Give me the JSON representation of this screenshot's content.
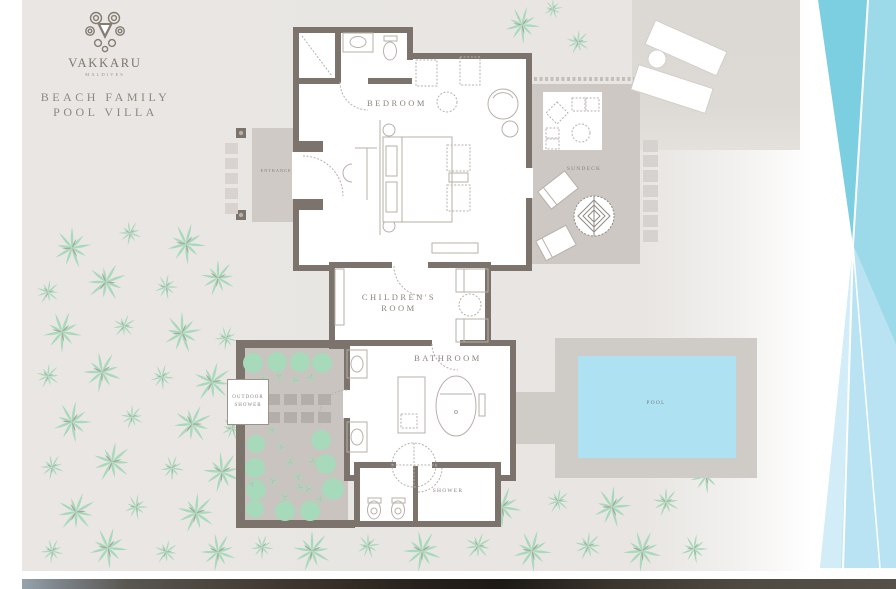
{
  "brand": {
    "name": "VAKKARU",
    "location": "MALDIVES"
  },
  "title": {
    "line1": "BEACH FAMILY",
    "line2": "POOL VILLA"
  },
  "labels": {
    "bedroom": "BEDROOM",
    "childrens_line1": "CHILDREN'S",
    "childrens_line2": "ROOM",
    "bathroom": "BATHROOM",
    "entrance": "ENTRANCE",
    "sundeck": "SUNDECK",
    "outdoor_line1": "OUTDOOR",
    "outdoor_line2": "SHOWER",
    "shower": "SHOWER",
    "pool": "POOL"
  },
  "colors": {
    "background": "#e9e6e3",
    "wall": "#7b736c",
    "room_fill": "#ffffff",
    "deck": "#cfcac5",
    "palm_green": "#a7d9bb",
    "pool_water": "#aee1f2",
    "wave_dark": "#7ccfe1",
    "wave_mid": "#9cdaea",
    "wave_light": "#b9e3f3",
    "wave_pale": "#d3edf8",
    "label_text": "#8a837b"
  },
  "decor": {
    "palms": [
      [
        72,
        248,
        1,
        0
      ],
      [
        130,
        233,
        0.6,
        30
      ],
      [
        186,
        244,
        1,
        15
      ],
      [
        48,
        292,
        0.62,
        50
      ],
      [
        106,
        282,
        1,
        70
      ],
      [
        166,
        287,
        0.62,
        10
      ],
      [
        218,
        278,
        0.9,
        40
      ],
      [
        62,
        332,
        1,
        20
      ],
      [
        124,
        326,
        0.6,
        60
      ],
      [
        182,
        333,
        1,
        0
      ],
      [
        226,
        338,
        0.6,
        25
      ],
      [
        48,
        376,
        0.62,
        45
      ],
      [
        102,
        372,
        1,
        30
      ],
      [
        162,
        377,
        0.62,
        15
      ],
      [
        212,
        382,
        1,
        55
      ],
      [
        72,
        422,
        1,
        10
      ],
      [
        132,
        417,
        0.6,
        40
      ],
      [
        192,
        424,
        1,
        65
      ],
      [
        232,
        428,
        0.6,
        0
      ],
      [
        52,
        467,
        0.62,
        30
      ],
      [
        112,
        462,
        1,
        50
      ],
      [
        172,
        468,
        0.62,
        20
      ],
      [
        222,
        472,
        1,
        35
      ],
      [
        76,
        512,
        1,
        60
      ],
      [
        136,
        507,
        0.62,
        10
      ],
      [
        196,
        513,
        1,
        45
      ],
      [
        52,
        551,
        0.6,
        25
      ],
      [
        108,
        548,
        1,
        15
      ],
      [
        166,
        552,
        0.62,
        55
      ],
      [
        218,
        552,
        0.92,
        30
      ],
      [
        262,
        547,
        0.6,
        20
      ],
      [
        312,
        551,
        1,
        40
      ],
      [
        368,
        546,
        0.62,
        0
      ],
      [
        422,
        551,
        1,
        30
      ],
      [
        478,
        546,
        0.7,
        60
      ],
      [
        532,
        551,
        1,
        15
      ],
      [
        588,
        546,
        0.72,
        45
      ],
      [
        642,
        551,
        1,
        25
      ],
      [
        694,
        549,
        0.72,
        10
      ],
      [
        448,
        502,
        0.6,
        35
      ],
      [
        502,
        507,
        1,
        20
      ],
      [
        558,
        501,
        0.62,
        50
      ],
      [
        612,
        507,
        1,
        5
      ],
      [
        666,
        502,
        0.72,
        40
      ],
      [
        706,
        476,
        0.85,
        15
      ],
      [
        522,
        25,
        0.9,
        15
      ],
      [
        578,
        42,
        0.62,
        45
      ],
      [
        553,
        9,
        0.5,
        0
      ]
    ],
    "garden_plants": [
      [
        263,
        379
      ],
      [
        279,
        376
      ],
      [
        295,
        380
      ],
      [
        311,
        377
      ],
      [
        272,
        430
      ],
      [
        281,
        447
      ],
      [
        290,
        462
      ],
      [
        298,
        477
      ],
      [
        308,
        489
      ],
      [
        313,
        461
      ],
      [
        252,
        484
      ],
      [
        273,
        481
      ],
      [
        300,
        487
      ],
      [
        320,
        499
      ],
      [
        285,
        497
      ]
    ],
    "garden_bushes": [
      [
        253,
        363,
        10
      ],
      [
        277,
        362,
        10
      ],
      [
        300,
        362,
        10
      ],
      [
        322,
        363,
        10
      ],
      [
        256,
        444,
        9
      ],
      [
        255,
        468,
        10
      ],
      [
        256,
        490,
        10
      ],
      [
        255,
        509,
        9
      ],
      [
        285,
        511,
        10
      ],
      [
        310,
        511,
        10
      ],
      [
        321,
        440,
        10
      ],
      [
        326,
        464,
        10
      ],
      [
        333,
        489,
        11
      ]
    ],
    "garden_stones": {
      "cols": [
        267,
        284,
        301,
        318
      ],
      "rows": [
        394,
        412
      ],
      "w": 13,
      "h": 11
    },
    "entrance_stones": {
      "x": 225,
      "ys": [
        143,
        158,
        173,
        188,
        203
      ],
      "w": 13,
      "h": 11
    },
    "sundeck_stones": {
      "x": 643,
      "ys": [
        140,
        155,
        170,
        185,
        200,
        215,
        230
      ],
      "w": 15,
      "h": 12
    }
  }
}
